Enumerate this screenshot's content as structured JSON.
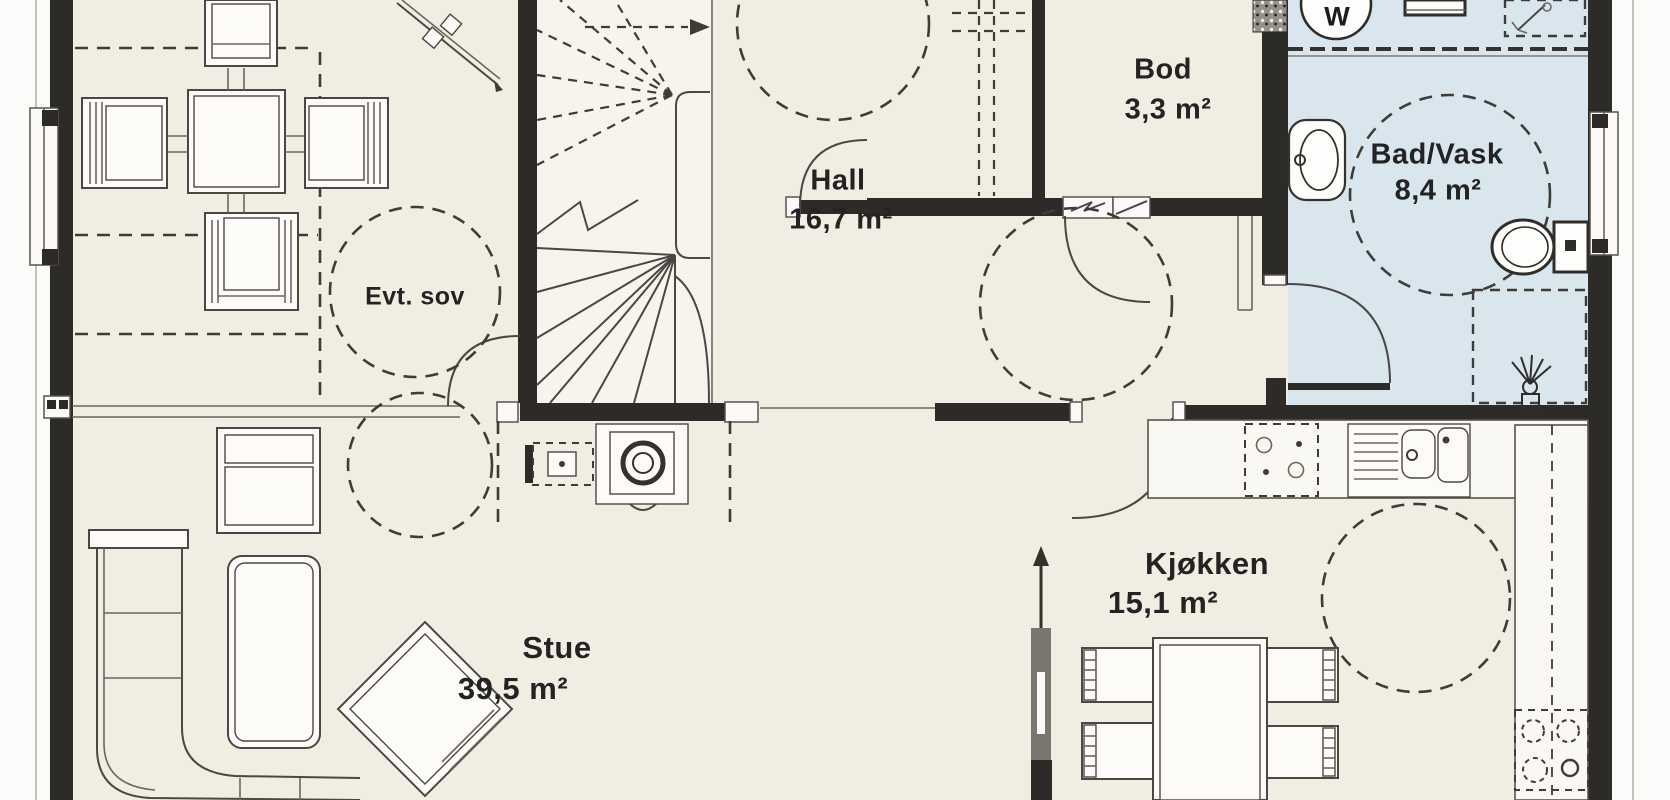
{
  "colors": {
    "background": "#fbfbf9",
    "floor": "#f2ede2",
    "bathroom-floor": "#d9e6ee",
    "wall": "#2d2b28",
    "line": "#4a4744",
    "text": "#232323"
  },
  "rooms": {
    "evt_sov": {
      "name": "Evt. sov"
    },
    "hall": {
      "name": "Hall",
      "area": "16,7 m²"
    },
    "bod": {
      "name": "Bod",
      "area": "3,3 m²"
    },
    "bad_vask": {
      "name": "Bad/Vask",
      "area": "8,4 m²"
    },
    "stue": {
      "name": "Stue",
      "area": "39,5 m²"
    },
    "kjokken": {
      "name": "Kjøkken",
      "area": "15,1 m²"
    }
  },
  "fixtures": {
    "washing_machine_label": "W"
  }
}
